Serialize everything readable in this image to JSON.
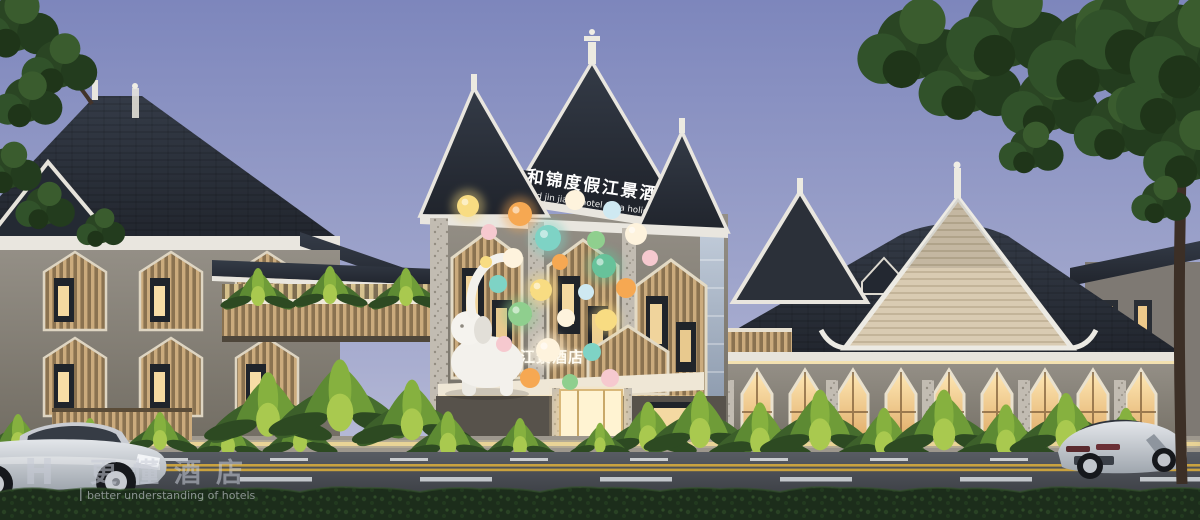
{
  "meta": {
    "type": "architectural-rendering",
    "subject": "Dai/Thai-style riverside resort hotel exterior",
    "time_of_day": "dusk"
  },
  "signs": {
    "rooftop": {
      "cn": "和锦度假江景酒店",
      "en": "And jin jiang hotel for a holiday"
    },
    "entrance": {
      "cn": "和锦度假江景酒店"
    }
  },
  "watermark": {
    "logo_latin": "H",
    "logo_cn": "更懂酒店",
    "tagline": "better understanding of hotels"
  },
  "palette": {
    "sky_top": "#7d86bc",
    "sky_bottom": "#bcc0db",
    "roof_dark": "#272c36",
    "trim_white": "#e9e6df",
    "wall_gray": "#8b867d",
    "wood_slat": "#c9ab7d",
    "window_glow": "#ffe3a6",
    "gable_cream": "#d9cbb2",
    "foliage_dark": "#2d4a26",
    "foliage_lit": "#8db53f",
    "road_asphalt": "#4a4e55",
    "lane_yellow": "#c9a23f",
    "hedge_green": "#1c2d1b",
    "balloon_colors": [
      "#fef3dd",
      "#f6c9cf",
      "#7ed3c5",
      "#8fcf8e",
      "#f6a852",
      "#f8dc82",
      "#cfe9f2",
      "#67c29a"
    ]
  }
}
